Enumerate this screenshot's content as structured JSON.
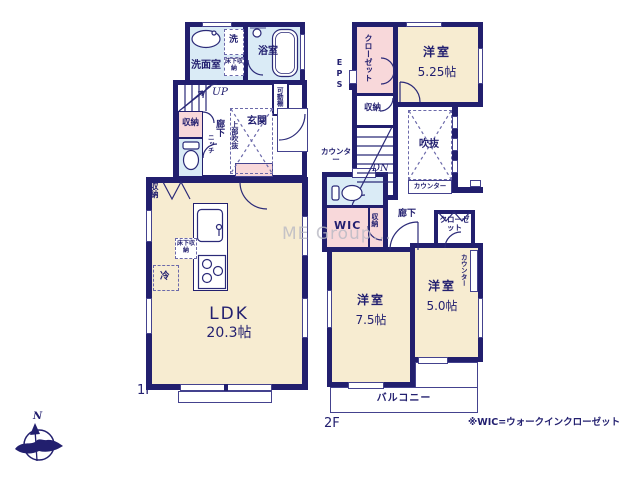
{
  "watermark": "ME Group...",
  "compass": {
    "north": "N"
  },
  "footnote": "※WIC=ウォークインクローゼット",
  "colors": {
    "wall": "#221f6e",
    "room_cream": "#f7ecd1",
    "room_pink": "#f8d8da",
    "room_blue": "#daebf6",
    "text": "#232070"
  },
  "floor1": {
    "label": "1F",
    "washroom": "洗面室",
    "washer": "洗",
    "underfloor_storage_top": "床下収納",
    "bathroom": "浴室",
    "movable_shelf": "可動棚",
    "stairs_up": "UP",
    "hall_storage": "収納",
    "hallway": "廊下",
    "niche": "ニッチ",
    "entrance": "玄関",
    "upper_void": "上部吹抜",
    "ldk_storage": "収納",
    "ldk_underfloor_storage": "床下収納",
    "fridge": "冷",
    "ldk_name": "LDK",
    "ldk_size": "20.3帖"
  },
  "floor2": {
    "label": "2F",
    "eps": "EPS",
    "closet_north": "クローゼット",
    "bedroom_a_name": "洋室",
    "bedroom_a_size": "5.25帖",
    "storage_north": "収納",
    "stairs_down": "DN",
    "void": "吹抜",
    "void_counter": "カウンター",
    "toilet_counter": "カウンター",
    "wic": "WIC",
    "wic_storage": "収納",
    "hallway": "廊下",
    "closet_south": "クローゼット",
    "bedroom_b_name": "洋室",
    "bedroom_b_size": "7.5帖",
    "bedroom_c_name": "洋室",
    "bedroom_c_size": "5.0帖",
    "bedroom_c_counter": "カウンター",
    "balcony": "バルコニー"
  }
}
